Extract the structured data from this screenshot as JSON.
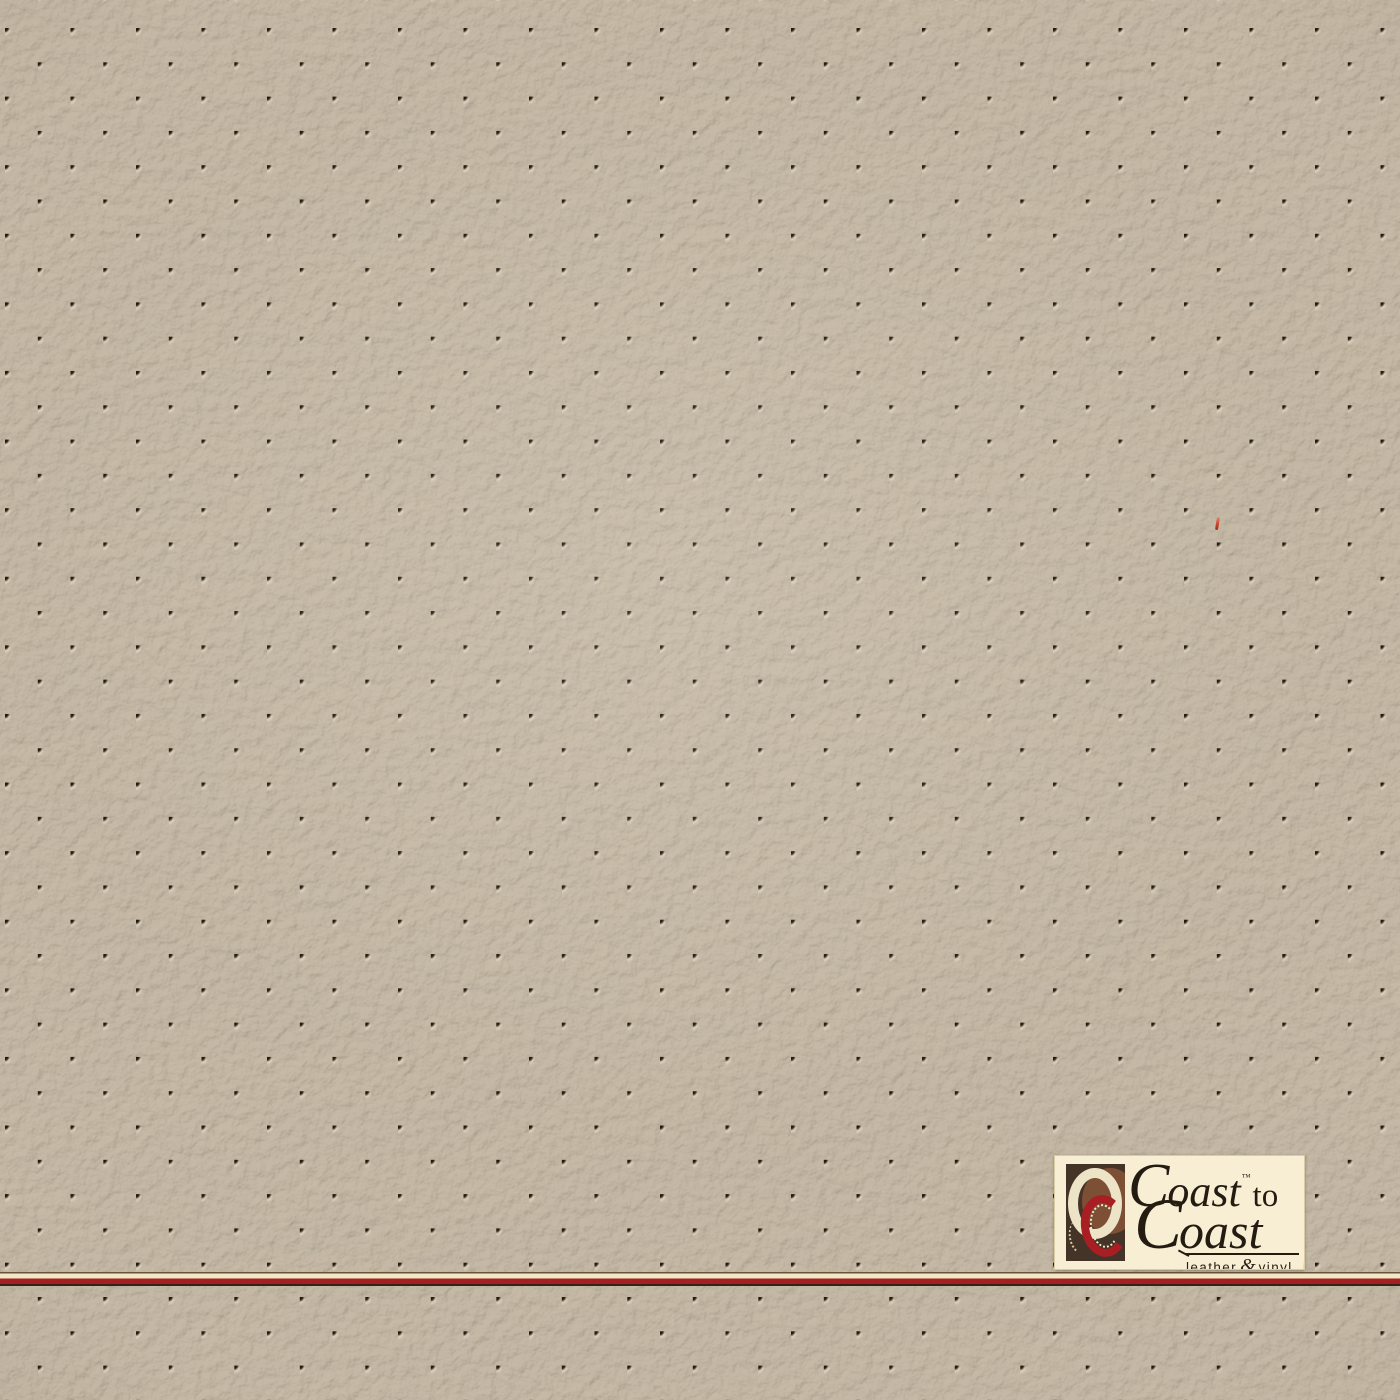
{
  "photo": {
    "subject": "perforated leather vinyl swatch",
    "texture": {
      "perforation_h_pitch_px": 65.5,
      "perforation_row_pitch_px": 34.3,
      "perforation_hole_diameter_px": 6,
      "pattern": "staggered diamond lattice"
    },
    "colors": {
      "leather_base": "#bcae96",
      "leather_highlight": "#d2c6ae",
      "leather_shadow": "#99Bc74",
      "hole": "#241a0f",
      "band_cream": "#f3e8c6",
      "band_red": "#a31f22",
      "band_dark": "#2f2418",
      "fiber_red": "#c7402a",
      "logo_background": "#f7eed3",
      "logo_text": "#241c12",
      "emblem_background": "#443427",
      "emblem_brown_circle": "#7d4f35",
      "emblem_cream_ring": "#ede3c6",
      "emblem_red_ring": "#a81e23"
    }
  },
  "logo": {
    "coast_top_cap": "C",
    "coast_top_rest": "oast",
    "trademark": "™",
    "to": "to",
    "coast_bottom_cap": "C",
    "coast_bottom_rest": "oast",
    "tagline_leather": "leather",
    "tagline_amp": "&",
    "tagline_vinyl": "vinyl, inc"
  }
}
